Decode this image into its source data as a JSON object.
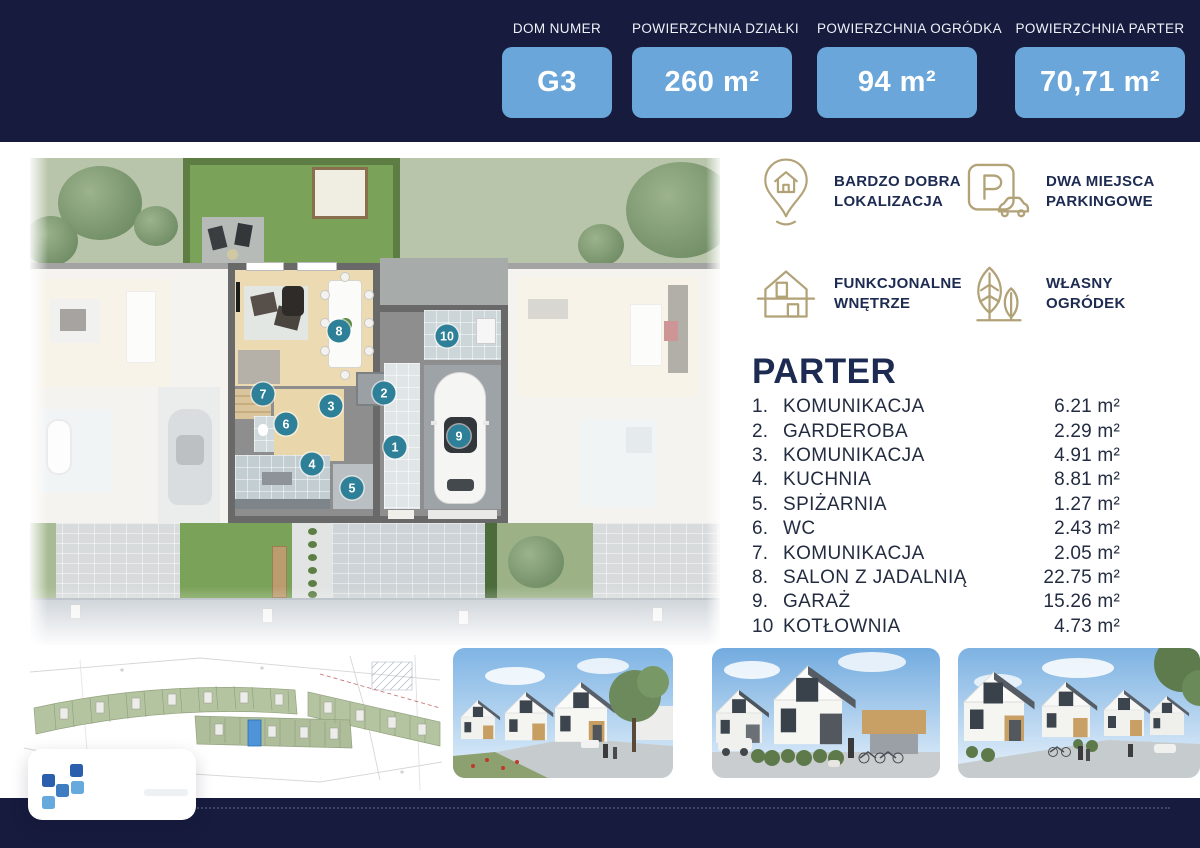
{
  "colors": {
    "navy": "#171b3e",
    "badge_blue": "#6aa6d9",
    "gold": "#b2a278",
    "text_navy": "#1d2b52",
    "marker_teal": "#2e7f98"
  },
  "header": {
    "badges": [
      {
        "label": "DOM NUMER",
        "value": "G3"
      },
      {
        "label": "POWIERZCHNIA DZIAŁKI",
        "value": "260 m²"
      },
      {
        "label": "POWIERZCHNIA OGRÓDKA",
        "value": "94 m²"
      },
      {
        "label": "POWIERZCHNIA PARTER",
        "value": "70,71 m²"
      }
    ]
  },
  "features": [
    {
      "icon": "location-pin-house-icon",
      "line1": "BARDZO DOBRA",
      "line2": "LOKALIZACJA"
    },
    {
      "icon": "parking-sign-car-icon",
      "line1": "DWA MIEJSCA",
      "line2": "PARKINGOWE"
    },
    {
      "icon": "house-interior-icon",
      "line1": "FUNKCJONALNE",
      "line2": "WNĘTRZE"
    },
    {
      "icon": "garden-leaves-icon",
      "line1": "WŁASNY",
      "line2": "OGRÓDEK"
    }
  ],
  "floor": {
    "title": "PARTER",
    "rooms": [
      {
        "list_num": "1.",
        "plan_num": "1",
        "name": "KOMUNIKACJA",
        "area": "6.21 m²",
        "x": "365px",
        "y": "289px"
      },
      {
        "list_num": "2.",
        "plan_num": "2",
        "name": "GARDEROBA",
        "area": "2.29 m²",
        "x": "354px",
        "y": "235px"
      },
      {
        "list_num": "3.",
        "plan_num": "3",
        "name": "KOMUNIKACJA",
        "area": "4.91 m²",
        "x": "301px",
        "y": "248px"
      },
      {
        "list_num": "4.",
        "plan_num": "4",
        "name": "KUCHNIA",
        "area": "8.81 m²",
        "x": "282px",
        "y": "306px"
      },
      {
        "list_num": "5.",
        "plan_num": "5",
        "name": "SPIŻARNIA",
        "area": "1.27 m²",
        "x": "322px",
        "y": "330px"
      },
      {
        "list_num": "6.",
        "plan_num": "6",
        "name": "WC",
        "area": "2.43 m²",
        "x": "256px",
        "y": "266px"
      },
      {
        "list_num": "7.",
        "plan_num": "7",
        "name": "KOMUNIKACJA",
        "area": "2.05 m²",
        "x": "233px",
        "y": "236px"
      },
      {
        "list_num": "8.",
        "plan_num": "8",
        "name": "SALON Z JADALNIĄ",
        "area": "22.75 m²",
        "x": "309px",
        "y": "173px"
      },
      {
        "list_num": "9.",
        "plan_num": "9",
        "name": "GARAŻ",
        "area": "15.26 m²",
        "x": "429px",
        "y": "278px"
      },
      {
        "list_num": "10",
        "plan_num": "10",
        "name": "KOTŁOWNIA",
        "area": "4.73 m²",
        "x": "417px",
        "y": "178px"
      }
    ]
  },
  "branding": {
    "logo_icon": "pixel-squares-logo-icon"
  }
}
